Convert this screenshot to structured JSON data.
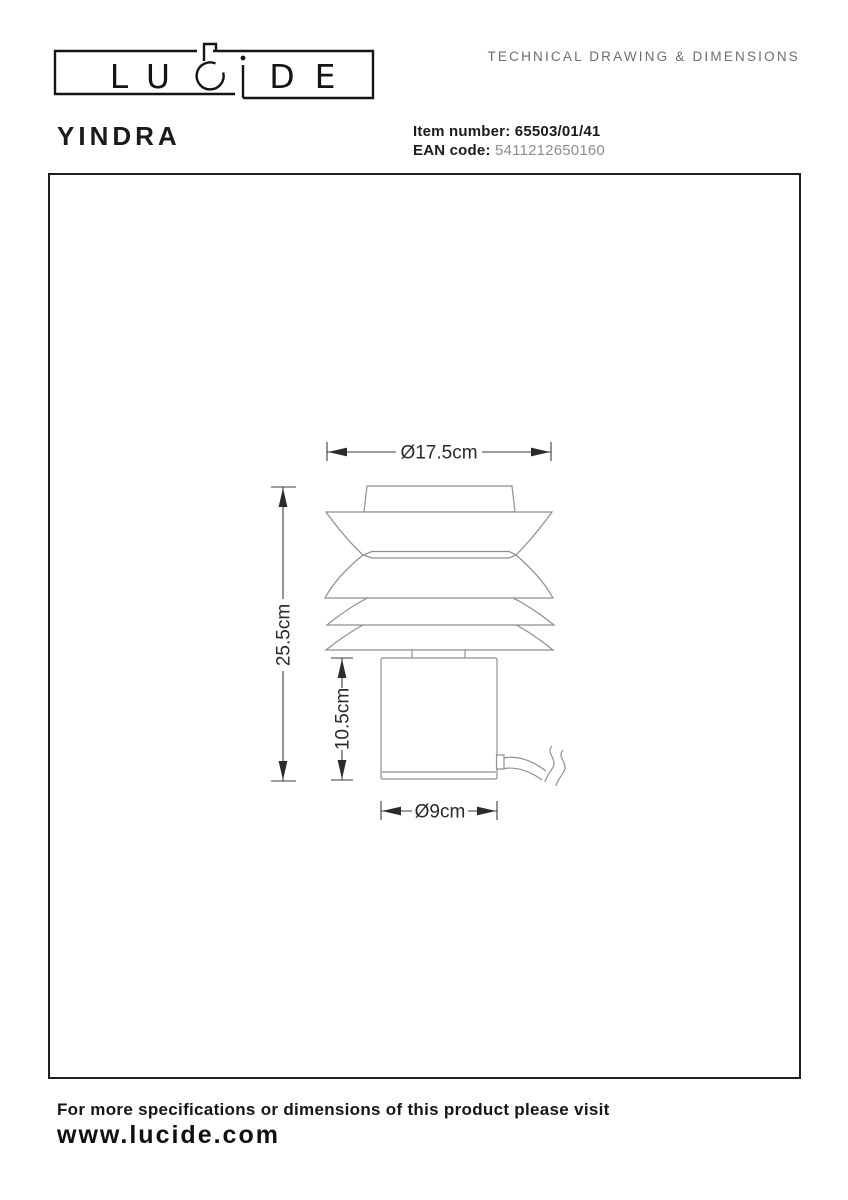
{
  "header": {
    "doc_title": "TECHNICAL DRAWING & DIMENSIONS",
    "product_name": "YINDRA",
    "item_number_label": "Item number:",
    "item_number_value": "65503/01/41",
    "ean_label": "EAN code:",
    "ean_value": "5411212650160",
    "logo": {
      "letters": [
        "L",
        "U",
        "C",
        "i",
        "D",
        "E"
      ]
    }
  },
  "drawing": {
    "dimensions": {
      "shade_diameter": "Ø17.5cm",
      "total_height": "25.5cm",
      "base_height": "10.5cm",
      "base_diameter": "Ø9cm"
    }
  },
  "footer": {
    "line1": "For more specifications or dimensions of this product please visit",
    "line2": "www.lucide.com"
  },
  "colors": {
    "text_black": "#161616",
    "muted_grey": "#6e6e6e",
    "ean_grey": "#8d8d8d",
    "lamp_outline": "#8f8f8f",
    "dimension_lines": "#3d3d3d",
    "box_border": "#1f1f1f",
    "background": "#ffffff"
  }
}
